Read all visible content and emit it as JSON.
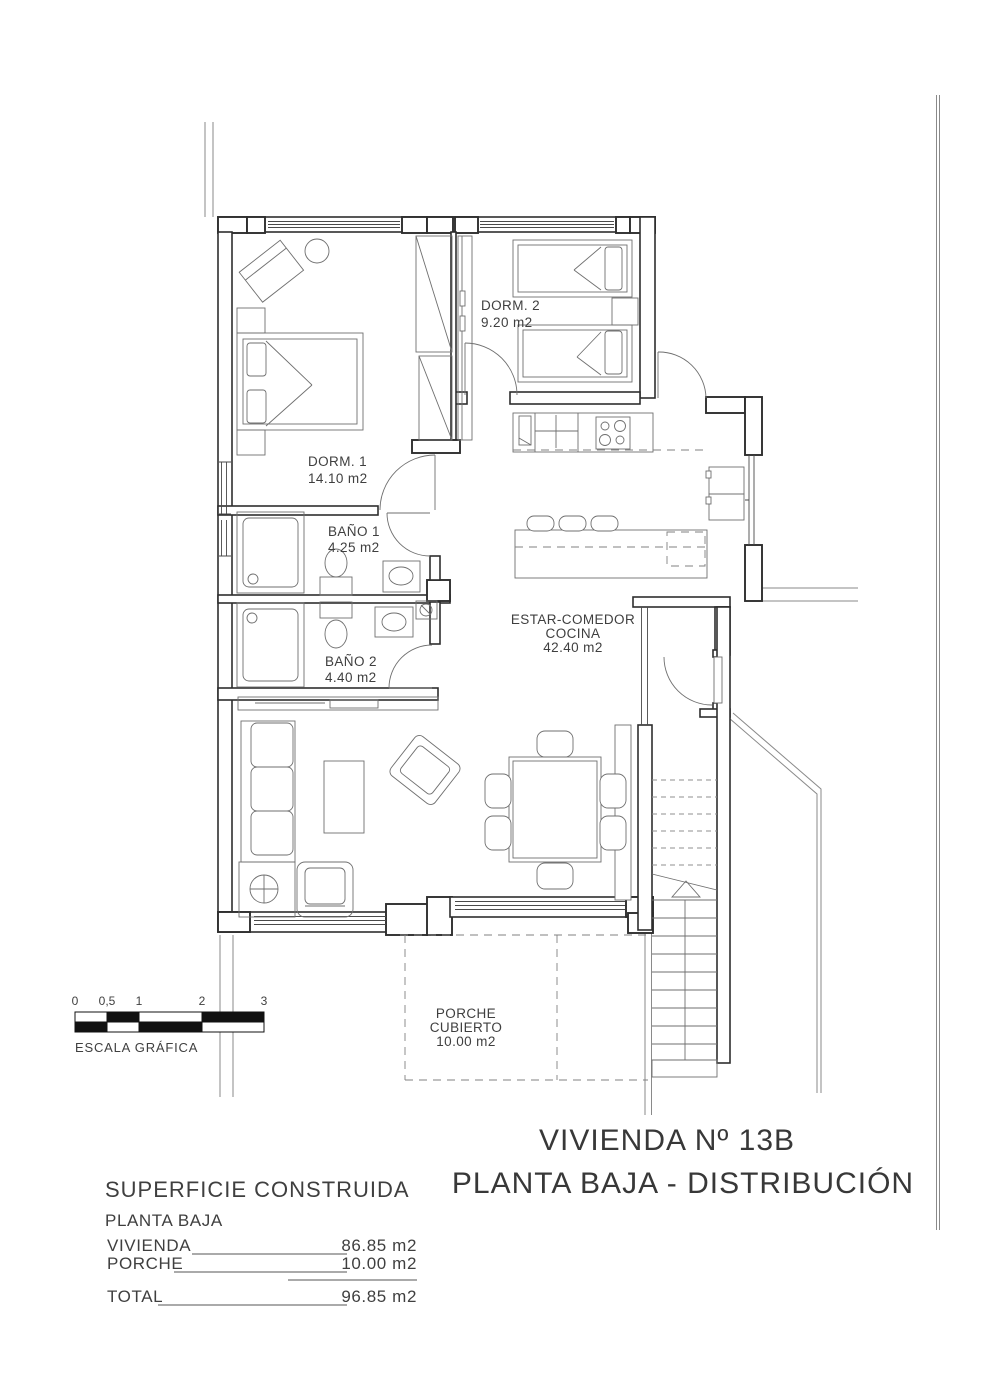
{
  "title": {
    "line1": "VIVIENDA Nº 13B",
    "line2": "PLANTA BAJA - DISTRIBUCIÓN"
  },
  "plan": {
    "rooms": [
      {
        "id": "dorm1",
        "name": "DORM. 1",
        "area": "14.10 m2"
      },
      {
        "id": "dorm2",
        "name": "DORM. 2",
        "area": "9.20 m2"
      },
      {
        "id": "bano1",
        "name": "BAÑO 1",
        "area": "4.25 m2"
      },
      {
        "id": "bano2",
        "name": "BAÑO 2",
        "area": "4.40 m2"
      },
      {
        "id": "estar",
        "name": "ESTAR-COMEDOR",
        "name2": "COCINA",
        "area": "42.40 m2"
      },
      {
        "id": "porche",
        "name": "PORCHE",
        "name2": "CUBIERTO",
        "area": "10.00 m2"
      }
    ]
  },
  "scale_bar": {
    "labels": [
      "0",
      "0,5",
      "1",
      "2",
      "3"
    ],
    "caption": "ESCALA GRÁFICA"
  },
  "summary": {
    "heading": "SUPERFICIE CONSTRUIDA",
    "subheading": "PLANTA BAJA",
    "rows": [
      {
        "label": "VIVIENDA",
        "value": "86.85 m2"
      },
      {
        "label": "PORCHE",
        "value": "10.00 m2"
      }
    ],
    "total": {
      "label": "TOTAL",
      "value": "96.85 m2"
    }
  },
  "colors": {
    "ink": "#2e2e2e",
    "thin": "#6f6f6f",
    "text": "#3f3f3f",
    "dash": "#808080",
    "site": "#8a8a8a",
    "paper": "#ffffff"
  }
}
